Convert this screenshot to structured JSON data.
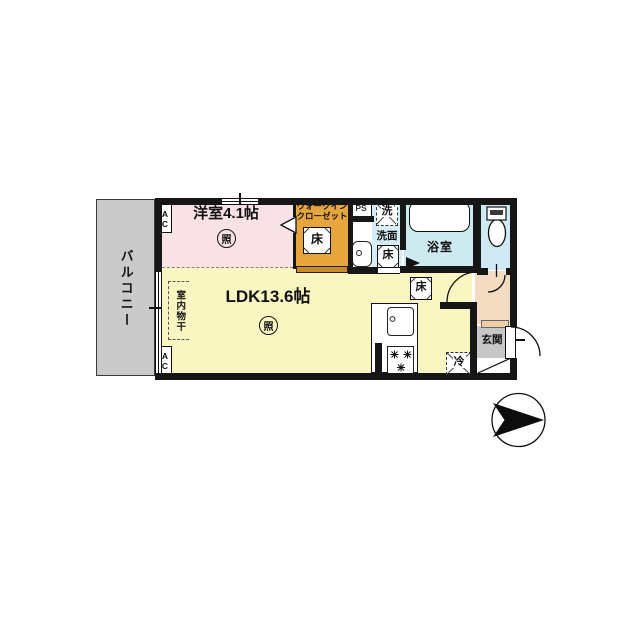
{
  "colors": {
    "wall": "#161616",
    "bedroom-pink": "#f8e2e6",
    "closet-orange": "#e7a53e",
    "closet-door": "#c98a2b",
    "ldk-yellow": "#faf6c2",
    "washroom-blue": "#d6edf6",
    "bathroom-cyan": "#cdeaf0",
    "toilet-blue": "#cfe9f5",
    "hall-peach": "#f4dcc3",
    "entrance-gray": "#c7c7c7",
    "balcony-gray": "#cacaca",
    "shoe-tan": "#eccfa9"
  },
  "floorplan": {
    "balcony": {
      "label": "バルコニー"
    },
    "bedroom": {
      "label": "洋室4.1帖",
      "light": "照",
      "ac": "AC"
    },
    "closet": {
      "line1": "ウォークイン",
      "line2": "クローゼット",
      "floor": "床"
    },
    "ps": {
      "label": "PS"
    },
    "washroom": {
      "label": "洗面",
      "washer": "洗",
      "floor": "床"
    },
    "bathroom": {
      "label": "浴室"
    },
    "ldk": {
      "label": "LDK13.6帖",
      "light": "照",
      "ac": "AC",
      "drying": "室内物干",
      "floor": "床",
      "fridge": "冷"
    },
    "entrance": {
      "label": "玄関"
    }
  }
}
